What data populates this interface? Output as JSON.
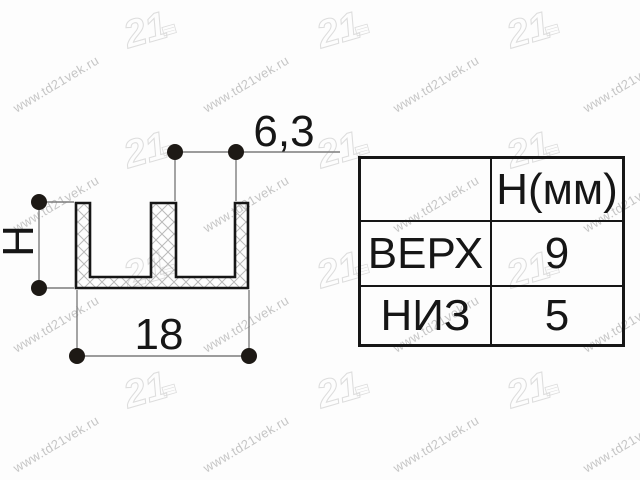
{
  "watermark": {
    "site": "www.td21vek.ru",
    "logo": "21"
  },
  "drawing": {
    "dim_top_width": "6,3",
    "dim_bottom_width": "18",
    "dim_height_label": "H"
  },
  "table": {
    "header": {
      "item_label": "",
      "param_label": "Н(мм)"
    },
    "rows": [
      {
        "label": "ВЕРХ",
        "value": "9"
      },
      {
        "label": "НИЗ",
        "value": "5"
      }
    ]
  },
  "colors": {
    "background": "#fdfdfd",
    "ink": "#161616",
    "dimension_line": "#7d7d7d",
    "hatch": "#b9b9b9",
    "watermark": "#bcbcbc"
  }
}
